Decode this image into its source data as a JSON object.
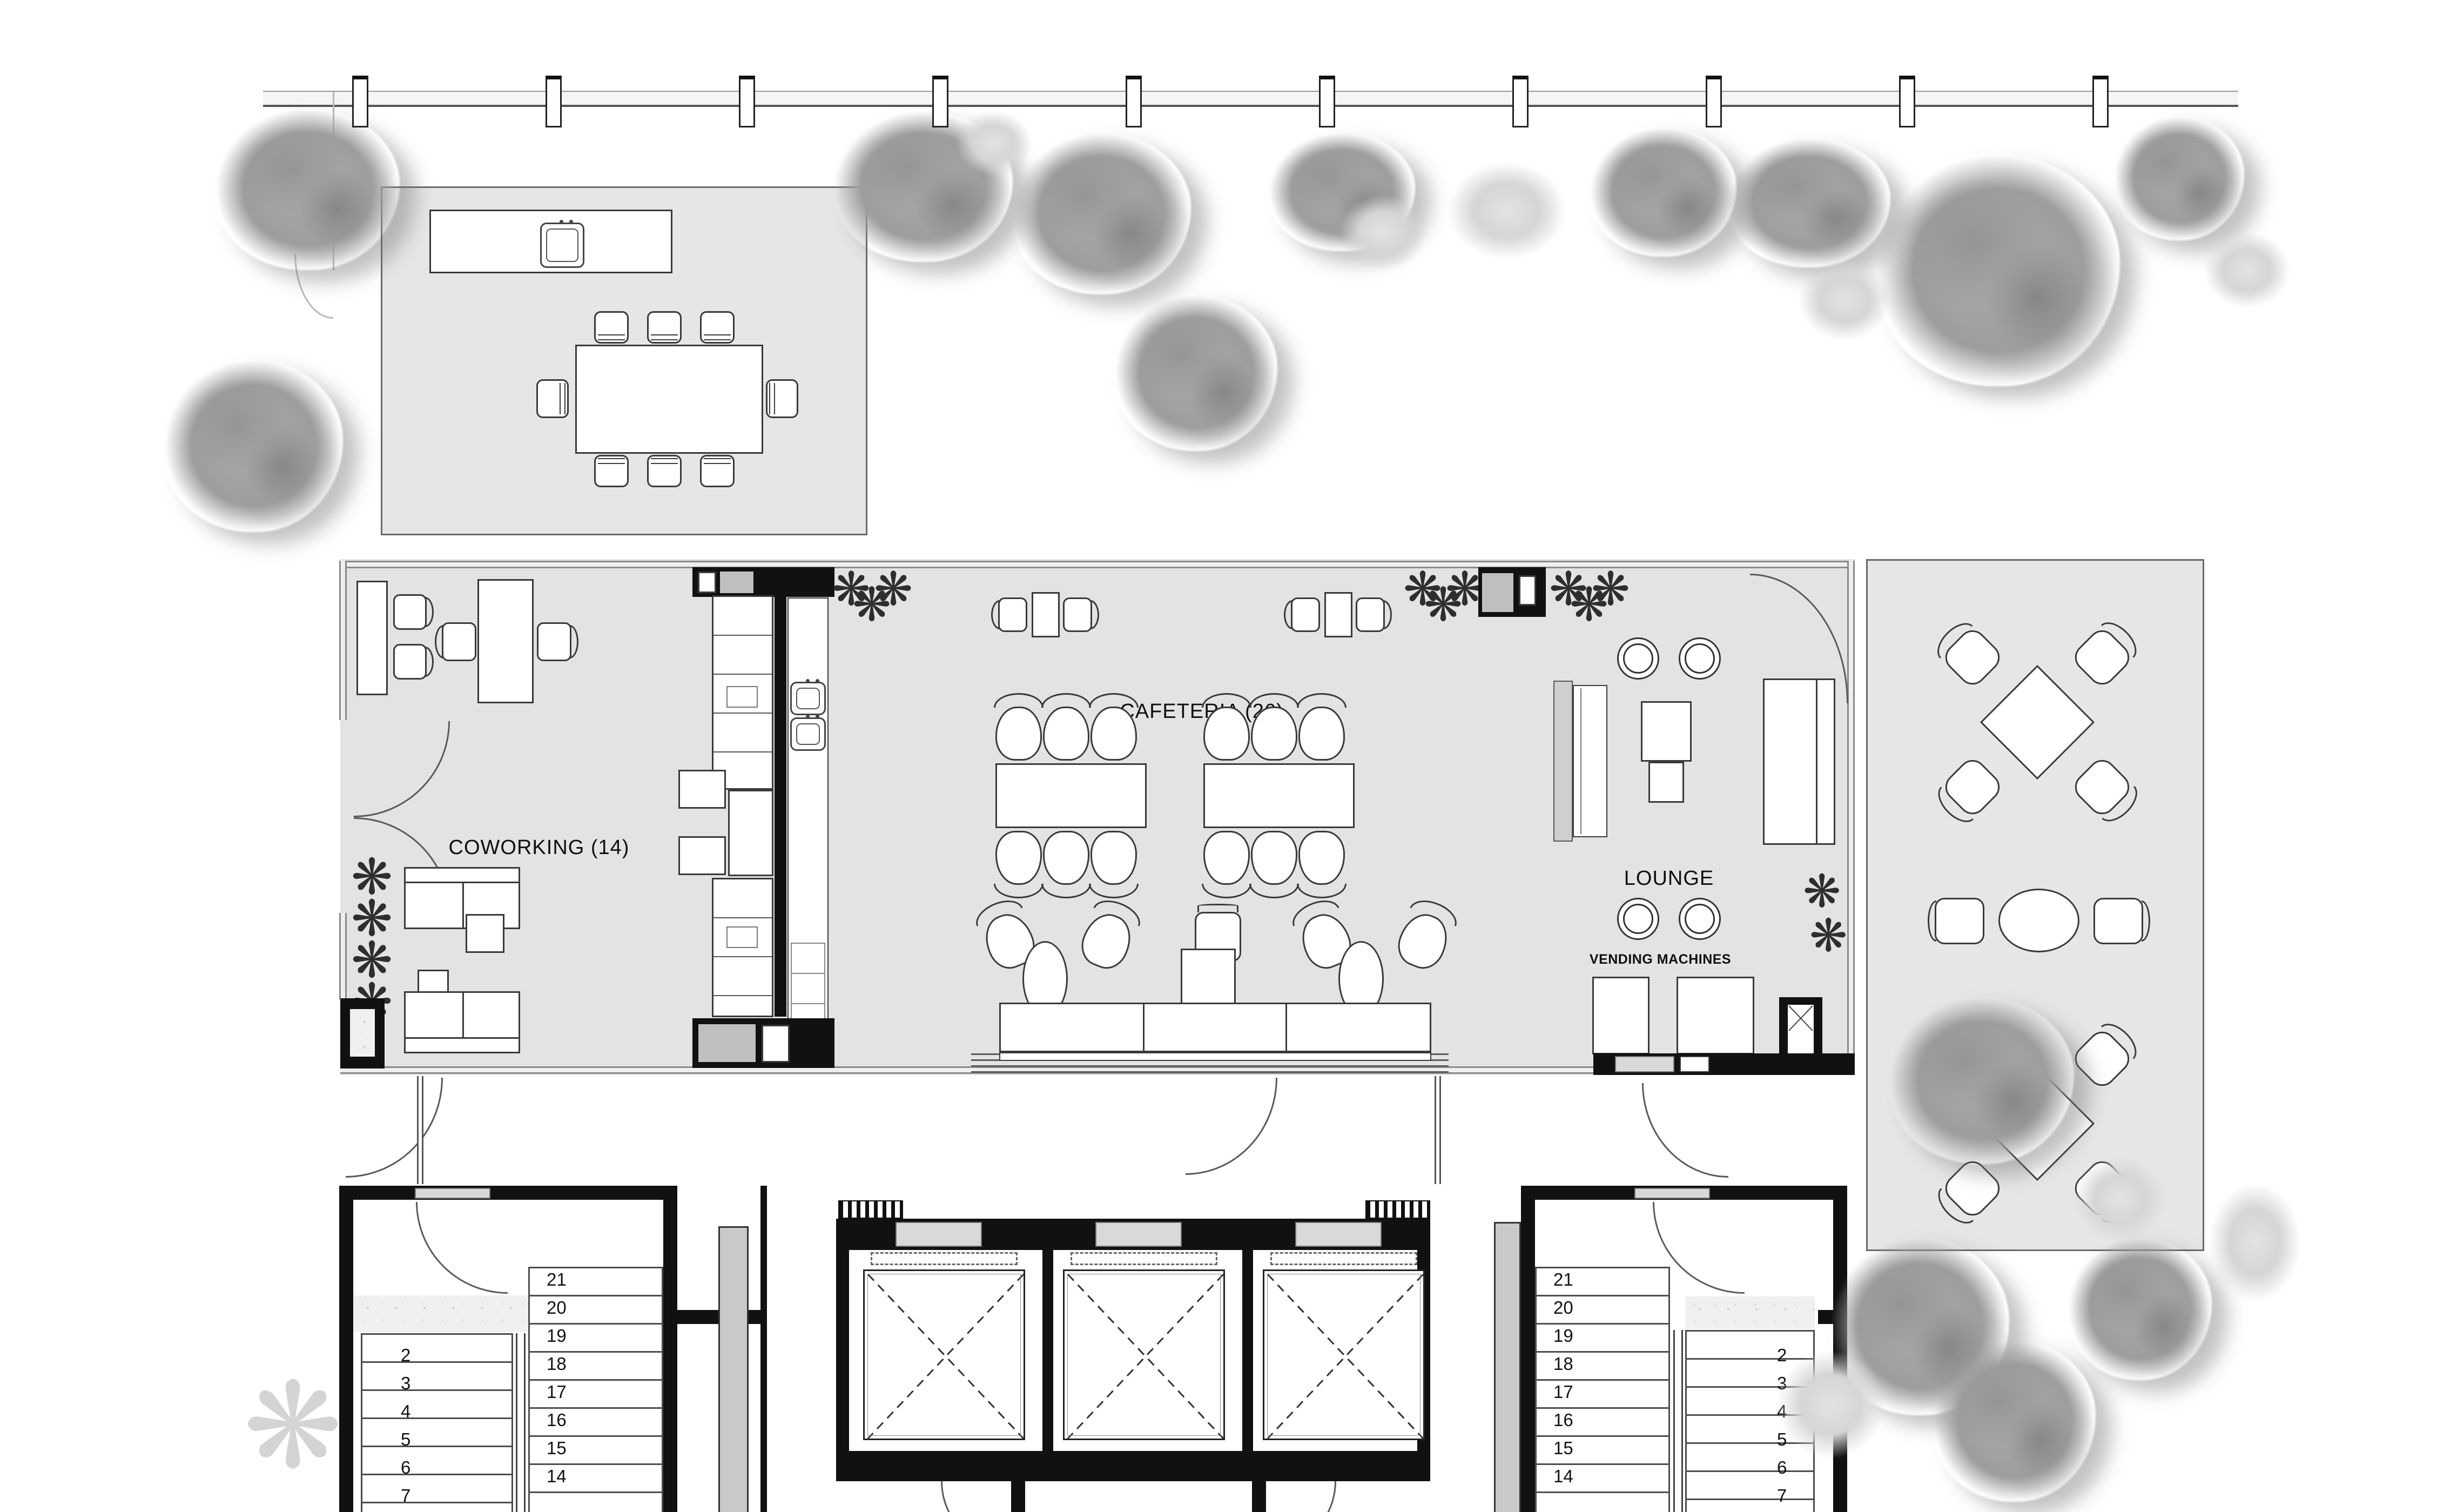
{
  "colors": {
    "floor": "#e3e3e3",
    "terrace": "#e6e6e6",
    "wall": "#111111",
    "door_block": "#bfbfbf",
    "glass_frame": "#8a8a8a"
  },
  "icons": {
    "plant": "❋"
  },
  "rooms": {
    "coworking": {
      "label": "COWORKING (14)"
    },
    "cafeteria": {
      "label": "CAFETERIA (26)"
    },
    "lounge": {
      "label": "LOUNGE"
    },
    "vending": {
      "label": "VENDING MACHINES"
    }
  },
  "stairs": {
    "left_core": {
      "flight_lower": [
        "2",
        "3",
        "4",
        "5",
        "6",
        "7"
      ],
      "flight_upper": [
        "21",
        "20",
        "19",
        "18",
        "17",
        "16",
        "15",
        "14"
      ]
    },
    "right_core": {
      "flight_upper": [
        "21",
        "20",
        "19",
        "18",
        "17",
        "16",
        "15",
        "14"
      ],
      "flight_lower": [
        "2",
        "3",
        "4",
        "5",
        "6",
        "7"
      ]
    }
  }
}
